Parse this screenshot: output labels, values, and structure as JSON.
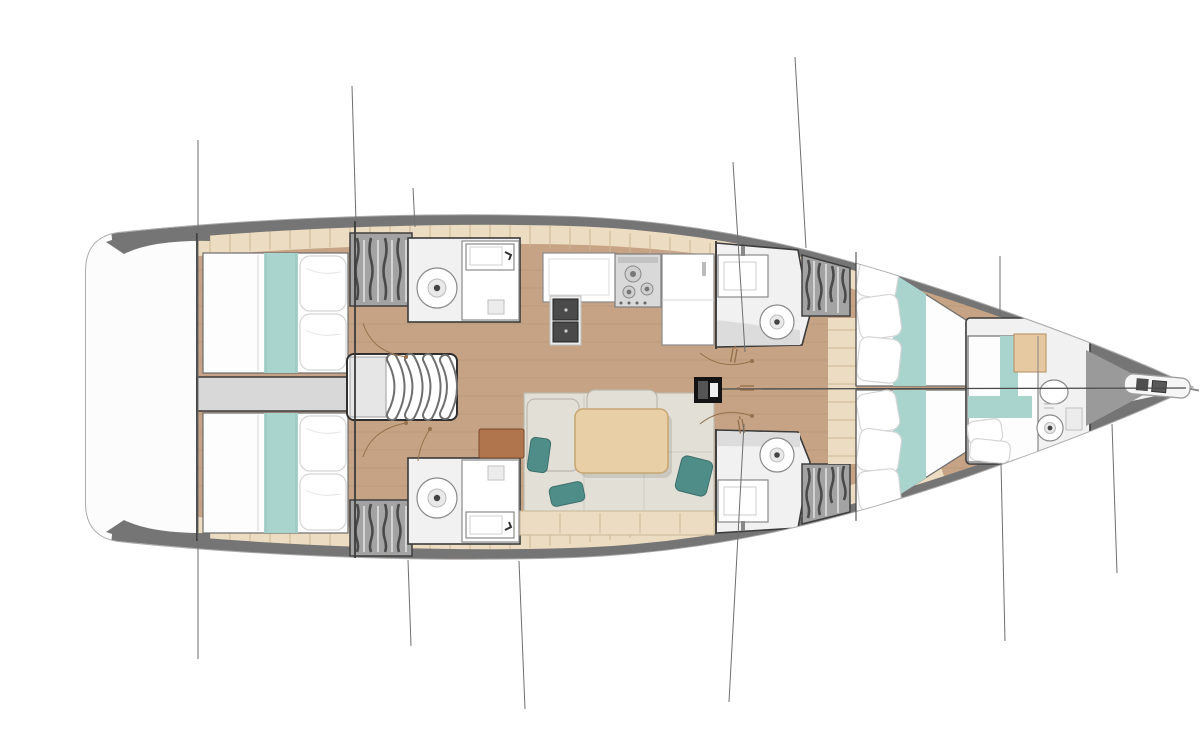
{
  "diagram": {
    "type": "yacht-interior-floor-plan",
    "view": "top-down",
    "orientation": "bow-right-stern-left",
    "layout_summary": {
      "double_berths": 5,
      "wet_heads": 5,
      "galley_burners": 3,
      "galley_sinks": 2,
      "companionway_steps": 4,
      "hanging_lockers": 4
    },
    "areas": [
      {
        "id": "stern-platform",
        "label": "open stern / transom area"
      },
      {
        "id": "aft-cabin-top",
        "label": "aft double cabin, bed with teal runner and two pillows"
      },
      {
        "id": "aft-cabin-bottom",
        "label": "aft double cabin, bed with teal runner and two pillows"
      },
      {
        "id": "engine-corridor",
        "label": "engine box corridor between aft cabins"
      },
      {
        "id": "companionway-stairs",
        "label": "companionway with four curved steps"
      },
      {
        "id": "aft-head-top",
        "label": "aft bathroom: toilet and sink"
      },
      {
        "id": "aft-head-bottom",
        "label": "aft bathroom: toilet and sink"
      },
      {
        "id": "locker-aft-top",
        "label": "hanging locker (hatched)"
      },
      {
        "id": "locker-aft-bottom",
        "label": "hanging locker (hatched)"
      },
      {
        "id": "galley",
        "label": "galley: counter, double sink, 3-burner stove, fridge column"
      },
      {
        "id": "salon",
        "label": "salon: L-sofa, wooden table, teal cushions, bench"
      },
      {
        "id": "nav-unit",
        "label": "terracotta side unit"
      },
      {
        "id": "mast-foot",
        "label": "mast foot with shroud turnbuckles"
      },
      {
        "id": "mid-head-top",
        "label": "mid bathroom: sink and toilet"
      },
      {
        "id": "mid-head-bottom",
        "label": "mid bathroom: sink and toilet"
      },
      {
        "id": "locker-mid-top",
        "label": "hanging locker (hatched)"
      },
      {
        "id": "locker-mid-bottom",
        "label": "hanging locker (hatched)"
      },
      {
        "id": "forward-berth-top",
        "label": "forward double berth with teal runner"
      },
      {
        "id": "forward-berth-bottom",
        "label": "forward double berth with teal runner"
      },
      {
        "id": "bow-cabin",
        "label": "bow cabin: berth, cabinet, en-suite toilet and sink"
      },
      {
        "id": "anchor-roller",
        "label": "bow anchor roller / sprit"
      },
      {
        "id": "rigging-lines",
        "label": "standing rigging lines crossing the hull"
      }
    ]
  },
  "colors": {
    "page-bg": "#ffffff",
    "hull-fill": "#ffffff",
    "hull-stroke": "#ababab",
    "deck-band": "#757575",
    "deck-beige": "#ecdcc1",
    "beige-tick": "#cdb795",
    "floor-wood": "#c5a384",
    "floor-plank": "#a98a68",
    "wall": "#3b3b3b",
    "stern-white": "#fcfcfc",
    "corridor": "#d8d8d8",
    "bed-white": "#fdfdfd",
    "teal-light": "#a9d3cd",
    "teal-dark": "#4f8d89",
    "pillow-stroke": "#d5d5d5",
    "sofa": "#e2dfd6",
    "sofa-stroke": "#bcb8ae",
    "table": "#e9cfa5",
    "table-stroke": "#c8a671",
    "bench": "#ecdcc1",
    "brown-unit": "#b1754e",
    "locker": "#a3a3a3",
    "locker-stroke": "#3f3f3f",
    "hatch-dark": "#4a4a4a",
    "hatch-light": "#d9d9d9",
    "fixture": "#f1f1f1",
    "fixture-stroke": "#8a8a8a",
    "sink-dark": "#4a4a4a",
    "stove": "#d9d9d9",
    "mast": "#141414",
    "rigging": "#6e6e6e",
    "door-arc": "#96714c",
    "bow-gray": "#9a9a9a",
    "anchor-white": "#f6f6f6"
  }
}
